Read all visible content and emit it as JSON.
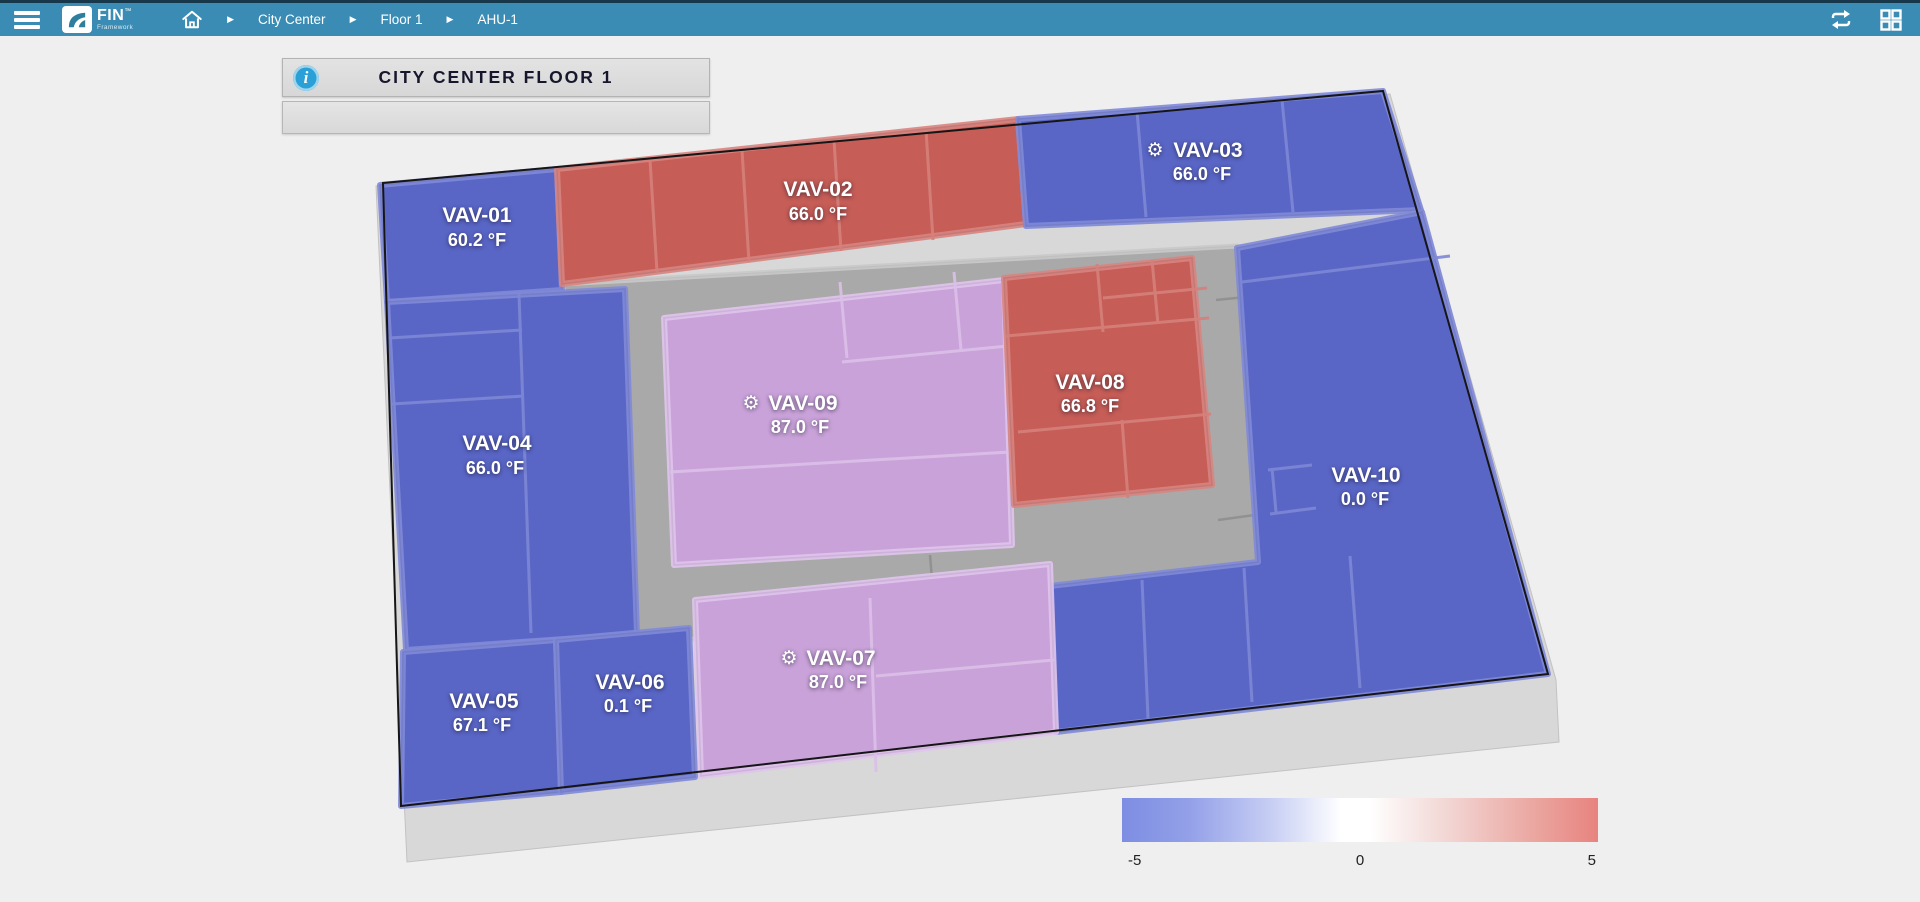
{
  "topbar": {
    "brand": {
      "name": "FIN",
      "tm": "™",
      "subtitle": "Framework"
    },
    "breadcrumb": [
      "City Center",
      "Floor 1",
      "AHU-1"
    ],
    "separator": "▶",
    "colors": {
      "bar": "#3a8cb4",
      "top_strip": "#16384a"
    }
  },
  "title_panel": {
    "title": "CITY CENTER FLOOR 1",
    "info_icon": "i"
  },
  "floorplan": {
    "zones": [
      {
        "name": "VAV-01",
        "temp": "60.2 °F",
        "color": "blue",
        "gear": ""
      },
      {
        "name": "VAV-02",
        "temp": "66.0 °F",
        "color": "red",
        "gear": ""
      },
      {
        "name": "VAV-03",
        "temp": "66.0 °F",
        "color": "blue",
        "gear": "⚙"
      },
      {
        "name": "VAV-04",
        "temp": "66.0 °F",
        "color": "blue",
        "gear": ""
      },
      {
        "name": "VAV-05",
        "temp": "67.1 °F",
        "color": "blue",
        "gear": ""
      },
      {
        "name": "VAV-06",
        "temp": "0.1 °F",
        "color": "blue",
        "gear": ""
      },
      {
        "name": "VAV-07",
        "temp": "87.0 °F",
        "color": "purple",
        "gear": "⚙"
      },
      {
        "name": "VAV-08",
        "temp": "66.8 °F",
        "color": "red",
        "gear": ""
      },
      {
        "name": "VAV-09",
        "temp": "87.0 °F",
        "color": "purple",
        "gear": "⚙"
      },
      {
        "name": "VAV-10",
        "temp": "0.0 °F",
        "color": "blue",
        "gear": ""
      }
    ],
    "colors": {
      "blue": "#5a66c6",
      "red": "#c65d57",
      "purple": "#c9a2d9",
      "corridor": "#a9a9a9",
      "slab": "#d8d8d8",
      "background": "#efefef"
    }
  },
  "legend": {
    "min": "-5",
    "mid": "0",
    "max": "5",
    "color_low": "#7d8de2",
    "color_mid": "#ffffff",
    "color_high": "#e8837f"
  }
}
